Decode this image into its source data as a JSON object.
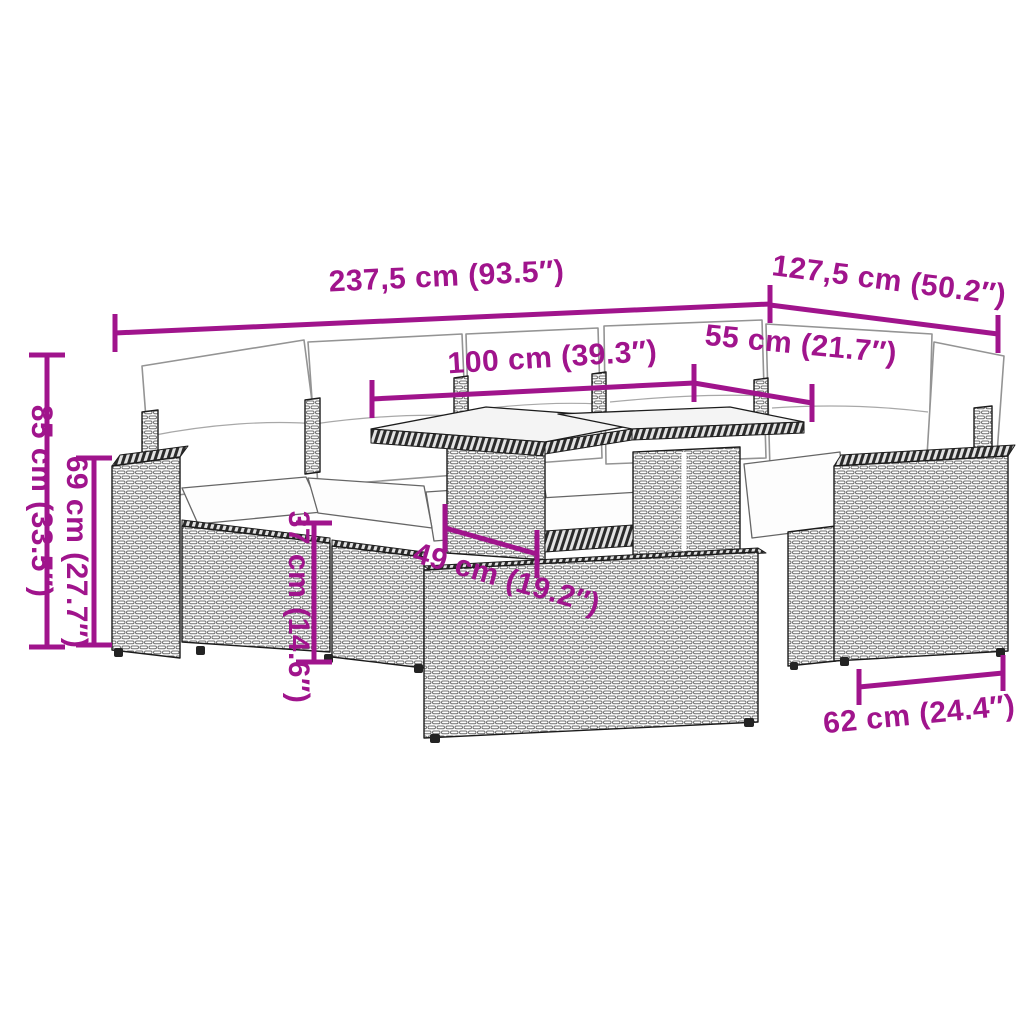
{
  "accent_color": "#a0148c",
  "diagram": {
    "description": "Line drawing of a poly rattan garden lounge set (corner sofa with back cushions, two-panel glass-top table, footstool and armchair) annotated with product dimensions"
  },
  "dimensions": {
    "total_width": {
      "label": "237,5 cm (93.5″)"
    },
    "right_depth": {
      "label": "127,5 cm (50.2″)"
    },
    "table_width": {
      "label": "100 cm (39.3″)"
    },
    "corner_width": {
      "label": "55 cm (21.7″)"
    },
    "total_height": {
      "label": "85 cm (33.5″)"
    },
    "armrest_height": {
      "label": "69 cm (27.7″)"
    },
    "seat_height": {
      "label": "37 cm (14.6″)"
    },
    "table_depth": {
      "label": "49 cm (19.2″)"
    },
    "module_depth": {
      "label": "62 cm (24.4″)"
    }
  }
}
